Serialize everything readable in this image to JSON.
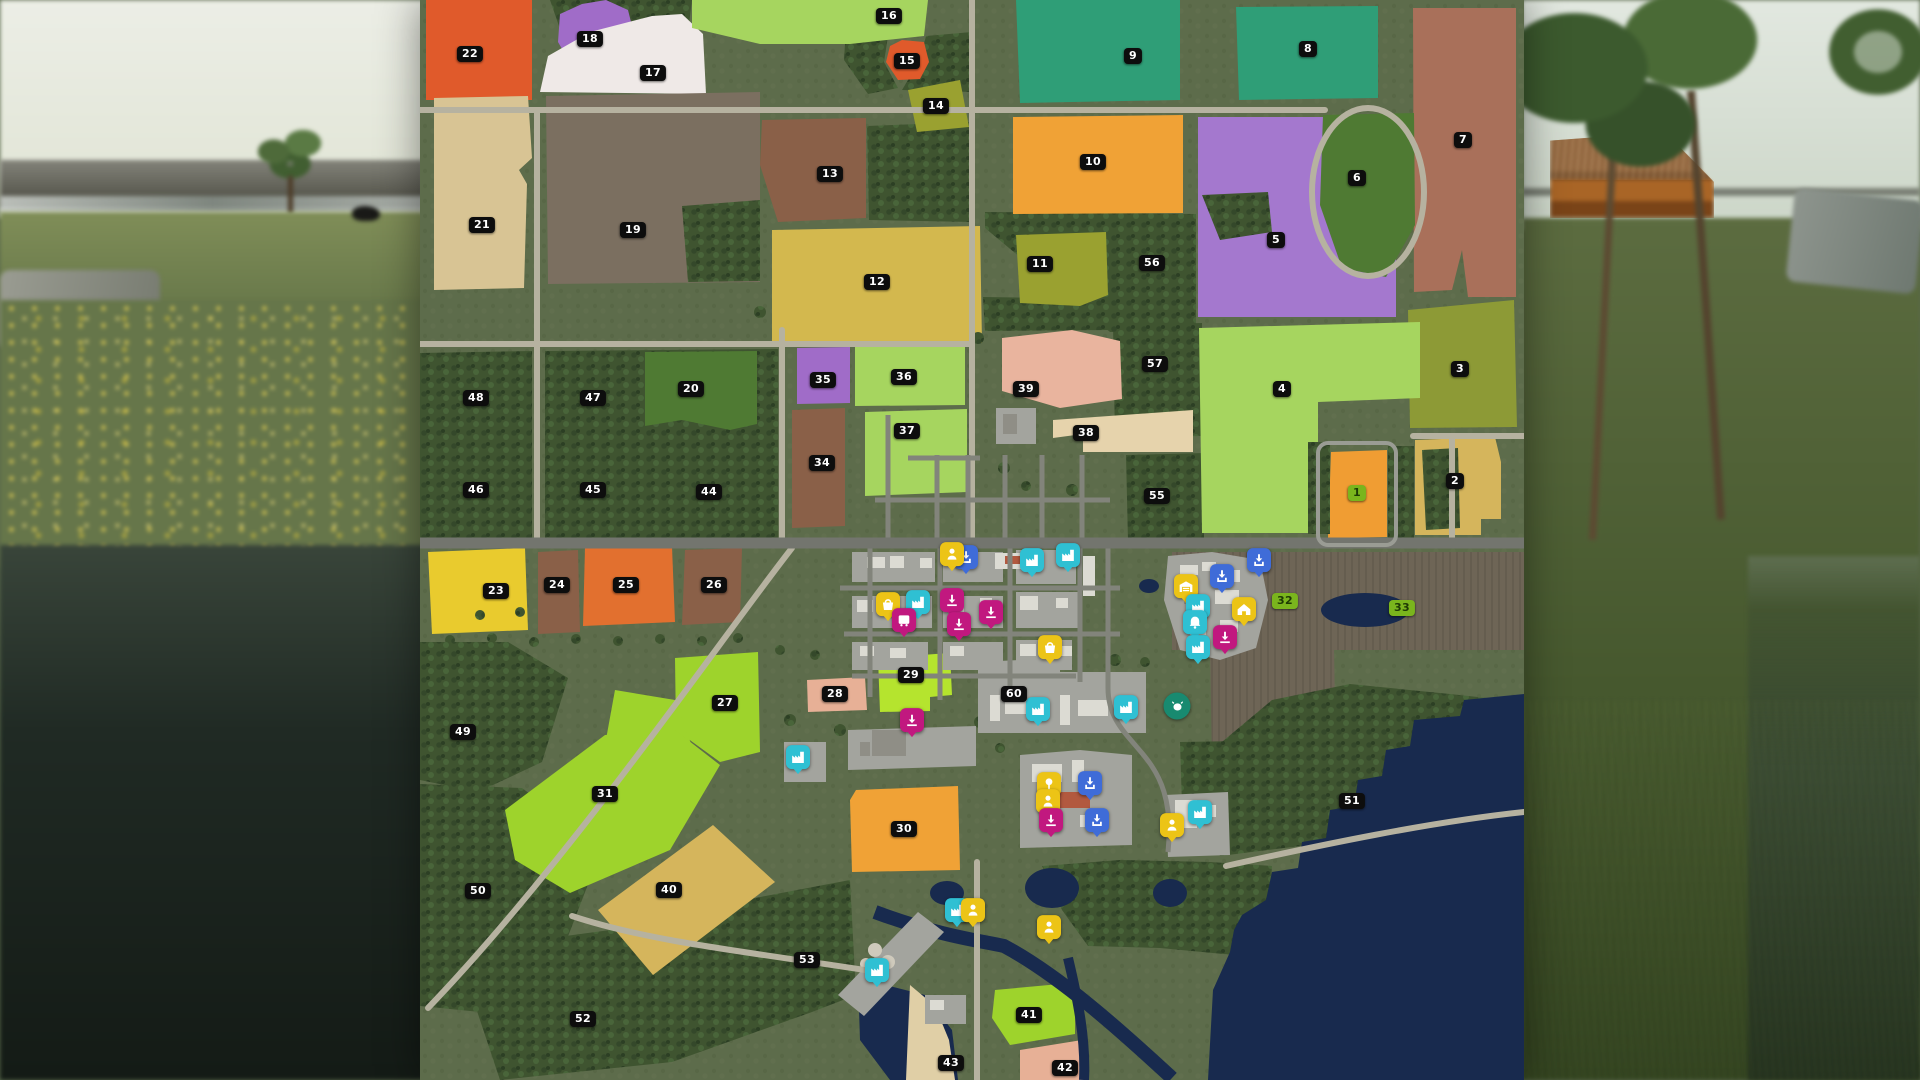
{
  "scene": {
    "game": "farming-simulator-map-overview",
    "view": "field-ownership-map"
  },
  "map": {
    "terrain_color": "#5d6c4b",
    "forest_color": "#3f5430",
    "water_color": "#182a4e",
    "plowed_color": "#6e6556",
    "sand_color": "#e0cfa6",
    "road_minor_color": "#b6b2a0",
    "road_major_color": "#73756e",
    "road_town_color": "#82847b",
    "yard_color": "#a3a49e",
    "label_style": {
      "bg": "#0d0d0d",
      "text": "#ffffff",
      "owned_bg": "#7ab51d",
      "owned_text": "#1e3a04"
    },
    "marker_types": {
      "production": {
        "color": "#2fc0d3",
        "glyph": "factory",
        "shape": "square"
      },
      "sell": {
        "color": "#c1187f",
        "glyph": "arrow-tray",
        "shape": "square"
      },
      "unload": {
        "color": "#3f6cd8",
        "glyph": "arrow-box",
        "shape": "square"
      },
      "mission": {
        "color": "#ecc416",
        "glyph": "person",
        "shape": "square"
      },
      "shop": {
        "color": "#ecc416",
        "glyph": "basket",
        "shape": "square"
      },
      "vehicle_shop": {
        "color": "#ecc416",
        "glyph": "garage",
        "shape": "square"
      },
      "farmhouse": {
        "color": "#ecc416",
        "glyph": "house",
        "shape": "square"
      },
      "bus_stop": {
        "color": "#c1187f",
        "glyph": "bus",
        "shape": "square"
      },
      "animal_dealer": {
        "color": "#188a70",
        "glyph": "cow",
        "shape": "round"
      },
      "forestry": {
        "color": "#ecc416",
        "glyph": "tree",
        "shape": "square"
      },
      "church": {
        "color": "#2fc0d3",
        "glyph": "bell",
        "shape": "square"
      }
    },
    "fields": [
      {
        "id": "1",
        "label": "1",
        "x": 937,
        "y": 493,
        "owned": true,
        "color": "#f09d33"
      },
      {
        "id": "2",
        "label": "2",
        "x": 1035,
        "y": 481,
        "owned": false,
        "color": "#d5b55c"
      },
      {
        "id": "3",
        "label": "3",
        "x": 1040,
        "y": 369,
        "owned": false,
        "color": "#8d9a36"
      },
      {
        "id": "4",
        "label": "4",
        "x": 862,
        "y": 389,
        "owned": false,
        "color": "#a6d55f"
      },
      {
        "id": "5",
        "label": "5",
        "x": 856,
        "y": 240,
        "owned": false,
        "color": "#a478ce"
      },
      {
        "id": "6",
        "label": "6",
        "x": 937,
        "y": 178,
        "owned": false,
        "color": "#4f7a33"
      },
      {
        "id": "7",
        "label": "7",
        "x": 1043,
        "y": 140,
        "owned": false,
        "color": "#a9705a"
      },
      {
        "id": "8",
        "label": "8",
        "x": 888,
        "y": 49,
        "owned": false,
        "color": "#2f9e77"
      },
      {
        "id": "9",
        "label": "9",
        "x": 713,
        "y": 56,
        "owned": false,
        "color": "#2f9e77"
      },
      {
        "id": "10",
        "label": "10",
        "x": 673,
        "y": 162,
        "owned": false,
        "color": "#f0a236"
      },
      {
        "id": "11",
        "label": "11",
        "x": 620,
        "y": 264,
        "owned": false,
        "color": "#9aa130"
      },
      {
        "id": "12",
        "label": "12",
        "x": 457,
        "y": 282,
        "owned": false,
        "color": "#d3b84e"
      },
      {
        "id": "13",
        "label": "13",
        "x": 410,
        "y": 174,
        "owned": false,
        "color": "#8a6048"
      },
      {
        "id": "14",
        "label": "14",
        "x": 516,
        "y": 106,
        "owned": false,
        "color": "#9aa130"
      },
      {
        "id": "15",
        "label": "15",
        "x": 487,
        "y": 61,
        "owned": false,
        "color": "#e05a2b"
      },
      {
        "id": "16",
        "label": "16",
        "x": 469,
        "y": 16,
        "owned": false,
        "color": "#a6d55f"
      },
      {
        "id": "17",
        "label": "17",
        "x": 233,
        "y": 73,
        "owned": false,
        "color": "#efe9e7"
      },
      {
        "id": "18",
        "label": "18",
        "x": 170,
        "y": 39,
        "owned": false,
        "color": "#a06cc8"
      },
      {
        "id": "19",
        "label": "19",
        "x": 213,
        "y": 230,
        "owned": false,
        "color": "#7b6f60"
      },
      {
        "id": "20",
        "label": "20",
        "x": 271,
        "y": 389,
        "owned": false,
        "color": "#4f7a33"
      },
      {
        "id": "21",
        "label": "21",
        "x": 62,
        "y": 225,
        "owned": false,
        "color": "#d8c494"
      },
      {
        "id": "22",
        "label": "22",
        "x": 50,
        "y": 54,
        "owned": false,
        "color": "#e05a2b"
      },
      {
        "id": "23",
        "label": "23",
        "x": 76,
        "y": 591,
        "owned": false,
        "color": "#e9cb2e"
      },
      {
        "id": "24",
        "label": "24",
        "x": 137,
        "y": 585,
        "owned": false,
        "color": "#8a6048"
      },
      {
        "id": "25",
        "label": "25",
        "x": 206,
        "y": 585,
        "owned": false,
        "color": "#e2702f"
      },
      {
        "id": "26",
        "label": "26",
        "x": 294,
        "y": 585,
        "owned": false,
        "color": "#8a6048"
      },
      {
        "id": "27",
        "label": "27",
        "x": 305,
        "y": 703,
        "owned": false,
        "color": "#9ed32c"
      },
      {
        "id": "28",
        "label": "28",
        "x": 415,
        "y": 694,
        "owned": false,
        "color": "#e7b096"
      },
      {
        "id": "29",
        "label": "29",
        "x": 491,
        "y": 675,
        "owned": false,
        "color": "#b5e42e"
      },
      {
        "id": "30",
        "label": "30",
        "x": 484,
        "y": 829,
        "owned": false,
        "color": "#f0a236"
      },
      {
        "id": "31",
        "label": "31",
        "x": 185,
        "y": 794,
        "owned": false,
        "color": "#9ed32c"
      },
      {
        "id": "32",
        "label": "32",
        "x": 865,
        "y": 601,
        "owned": true,
        "color": null
      },
      {
        "id": "33",
        "label": "33",
        "x": 982,
        "y": 608,
        "owned": true,
        "color": null
      },
      {
        "id": "34",
        "label": "34",
        "x": 402,
        "y": 463,
        "owned": false,
        "color": "#8a6048"
      },
      {
        "id": "35",
        "label": "35",
        "x": 403,
        "y": 380,
        "owned": false,
        "color": "#a06cc8"
      },
      {
        "id": "36",
        "label": "36",
        "x": 484,
        "y": 377,
        "owned": false,
        "color": "#a6d55f"
      },
      {
        "id": "37",
        "label": "37",
        "x": 487,
        "y": 431,
        "owned": false,
        "color": "#a6d55f"
      },
      {
        "id": "38",
        "label": "38",
        "x": 666,
        "y": 433,
        "owned": false,
        "color": "#e6d3ac"
      },
      {
        "id": "39",
        "label": "39",
        "x": 606,
        "y": 389,
        "owned": false,
        "color": "#e9b49e"
      },
      {
        "id": "40",
        "label": "40",
        "x": 249,
        "y": 890,
        "owned": false,
        "color": "#d5b55c"
      },
      {
        "id": "41",
        "label": "41",
        "x": 609,
        "y": 1015,
        "owned": false,
        "color": "#9ed32c"
      },
      {
        "id": "42",
        "label": "42",
        "x": 645,
        "y": 1068,
        "owned": false,
        "color": "#e7b096"
      },
      {
        "id": "43",
        "label": "43",
        "x": 531,
        "y": 1063,
        "owned": false,
        "color": "#e3d0a8"
      },
      {
        "id": "44",
        "label": "44",
        "x": 289,
        "y": 492,
        "owned": false,
        "color": null
      },
      {
        "id": "45",
        "label": "45",
        "x": 173,
        "y": 490,
        "owned": false,
        "color": null
      },
      {
        "id": "46",
        "label": "46",
        "x": 56,
        "y": 490,
        "owned": false,
        "color": null
      },
      {
        "id": "47",
        "label": "47",
        "x": 173,
        "y": 398,
        "owned": false,
        "color": null
      },
      {
        "id": "48",
        "label": "48",
        "x": 56,
        "y": 398,
        "owned": false,
        "color": null
      },
      {
        "id": "49",
        "label": "49",
        "x": 43,
        "y": 732,
        "owned": false,
        "color": null
      },
      {
        "id": "50",
        "label": "50",
        "x": 58,
        "y": 891,
        "owned": false,
        "color": null
      },
      {
        "id": "51",
        "label": "51",
        "x": 932,
        "y": 801,
        "owned": false,
        "color": null
      },
      {
        "id": "52",
        "label": "52",
        "x": 163,
        "y": 1019,
        "owned": false,
        "color": null
      },
      {
        "id": "53",
        "label": "53",
        "x": 387,
        "y": 960,
        "owned": false,
        "color": null
      },
      {
        "id": "55",
        "label": "55",
        "x": 737,
        "y": 496,
        "owned": false,
        "color": null
      },
      {
        "id": "56",
        "label": "56",
        "x": 732,
        "y": 263,
        "owned": false,
        "color": null
      },
      {
        "id": "57",
        "label": "57",
        "x": 735,
        "y": 364,
        "owned": false,
        "color": null
      },
      {
        "id": "60",
        "label": "60",
        "x": 594,
        "y": 694,
        "owned": false,
        "color": null
      }
    ],
    "markers": [
      {
        "type": "unload",
        "x": 546,
        "y": 560
      },
      {
        "type": "mission",
        "x": 532,
        "y": 557
      },
      {
        "type": "shop",
        "x": 468,
        "y": 607
      },
      {
        "type": "production",
        "x": 498,
        "y": 605
      },
      {
        "type": "bus_stop",
        "x": 484,
        "y": 623
      },
      {
        "type": "sell",
        "x": 532,
        "y": 603
      },
      {
        "type": "sell",
        "x": 539,
        "y": 627
      },
      {
        "type": "sell",
        "x": 571,
        "y": 615
      },
      {
        "type": "production",
        "x": 612,
        "y": 563
      },
      {
        "type": "production",
        "x": 648,
        "y": 558
      },
      {
        "type": "shop",
        "x": 630,
        "y": 650
      },
      {
        "type": "unload",
        "x": 839,
        "y": 563
      },
      {
        "type": "unload",
        "x": 802,
        "y": 579
      },
      {
        "type": "vehicle_shop",
        "x": 766,
        "y": 589
      },
      {
        "type": "production",
        "x": 778,
        "y": 609
      },
      {
        "type": "farmhouse",
        "x": 824,
        "y": 612
      },
      {
        "type": "church",
        "x": 775,
        "y": 625
      },
      {
        "type": "sell",
        "x": 805,
        "y": 640
      },
      {
        "type": "production",
        "x": 778,
        "y": 650
      },
      {
        "type": "sell",
        "x": 492,
        "y": 723
      },
      {
        "type": "production",
        "x": 378,
        "y": 760
      },
      {
        "type": "production",
        "x": 618,
        "y": 712
      },
      {
        "type": "production",
        "x": 706,
        "y": 710
      },
      {
        "type": "animal_dealer",
        "x": 757,
        "y": 706
      },
      {
        "type": "forestry",
        "x": 629,
        "y": 787
      },
      {
        "type": "mission",
        "x": 628,
        "y": 804
      },
      {
        "type": "sell",
        "x": 631,
        "y": 823
      },
      {
        "type": "unload",
        "x": 670,
        "y": 786
      },
      {
        "type": "unload",
        "x": 677,
        "y": 823
      },
      {
        "type": "mission",
        "x": 752,
        "y": 828
      },
      {
        "type": "production",
        "x": 780,
        "y": 815
      },
      {
        "type": "production",
        "x": 537,
        "y": 913
      },
      {
        "type": "mission",
        "x": 553,
        "y": 913
      },
      {
        "type": "mission",
        "x": 629,
        "y": 930
      },
      {
        "type": "production",
        "x": 457,
        "y": 973
      }
    ]
  }
}
